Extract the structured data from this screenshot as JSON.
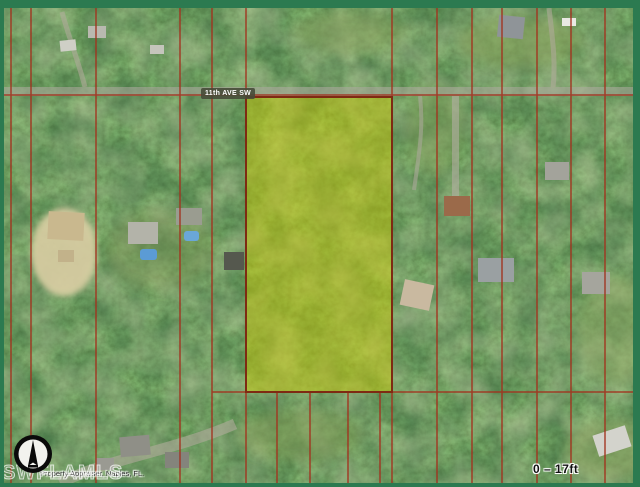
{
  "map": {
    "street_label": "11th AVE SW",
    "scale_label": "0 – 17ft",
    "watermark": "SWFLAMLS",
    "attribution": "Property Appraiser, Naples, FL.",
    "icons": {
      "compass": "north-compass-icon"
    },
    "colors": {
      "frame_green": "#2c7a50",
      "parcel_line_red": "#a2321f",
      "highlight_fill_yellow": "#d8ce00",
      "highlight_border": "#7e2a12",
      "canopy_base_green": "#4a6540"
    }
  }
}
